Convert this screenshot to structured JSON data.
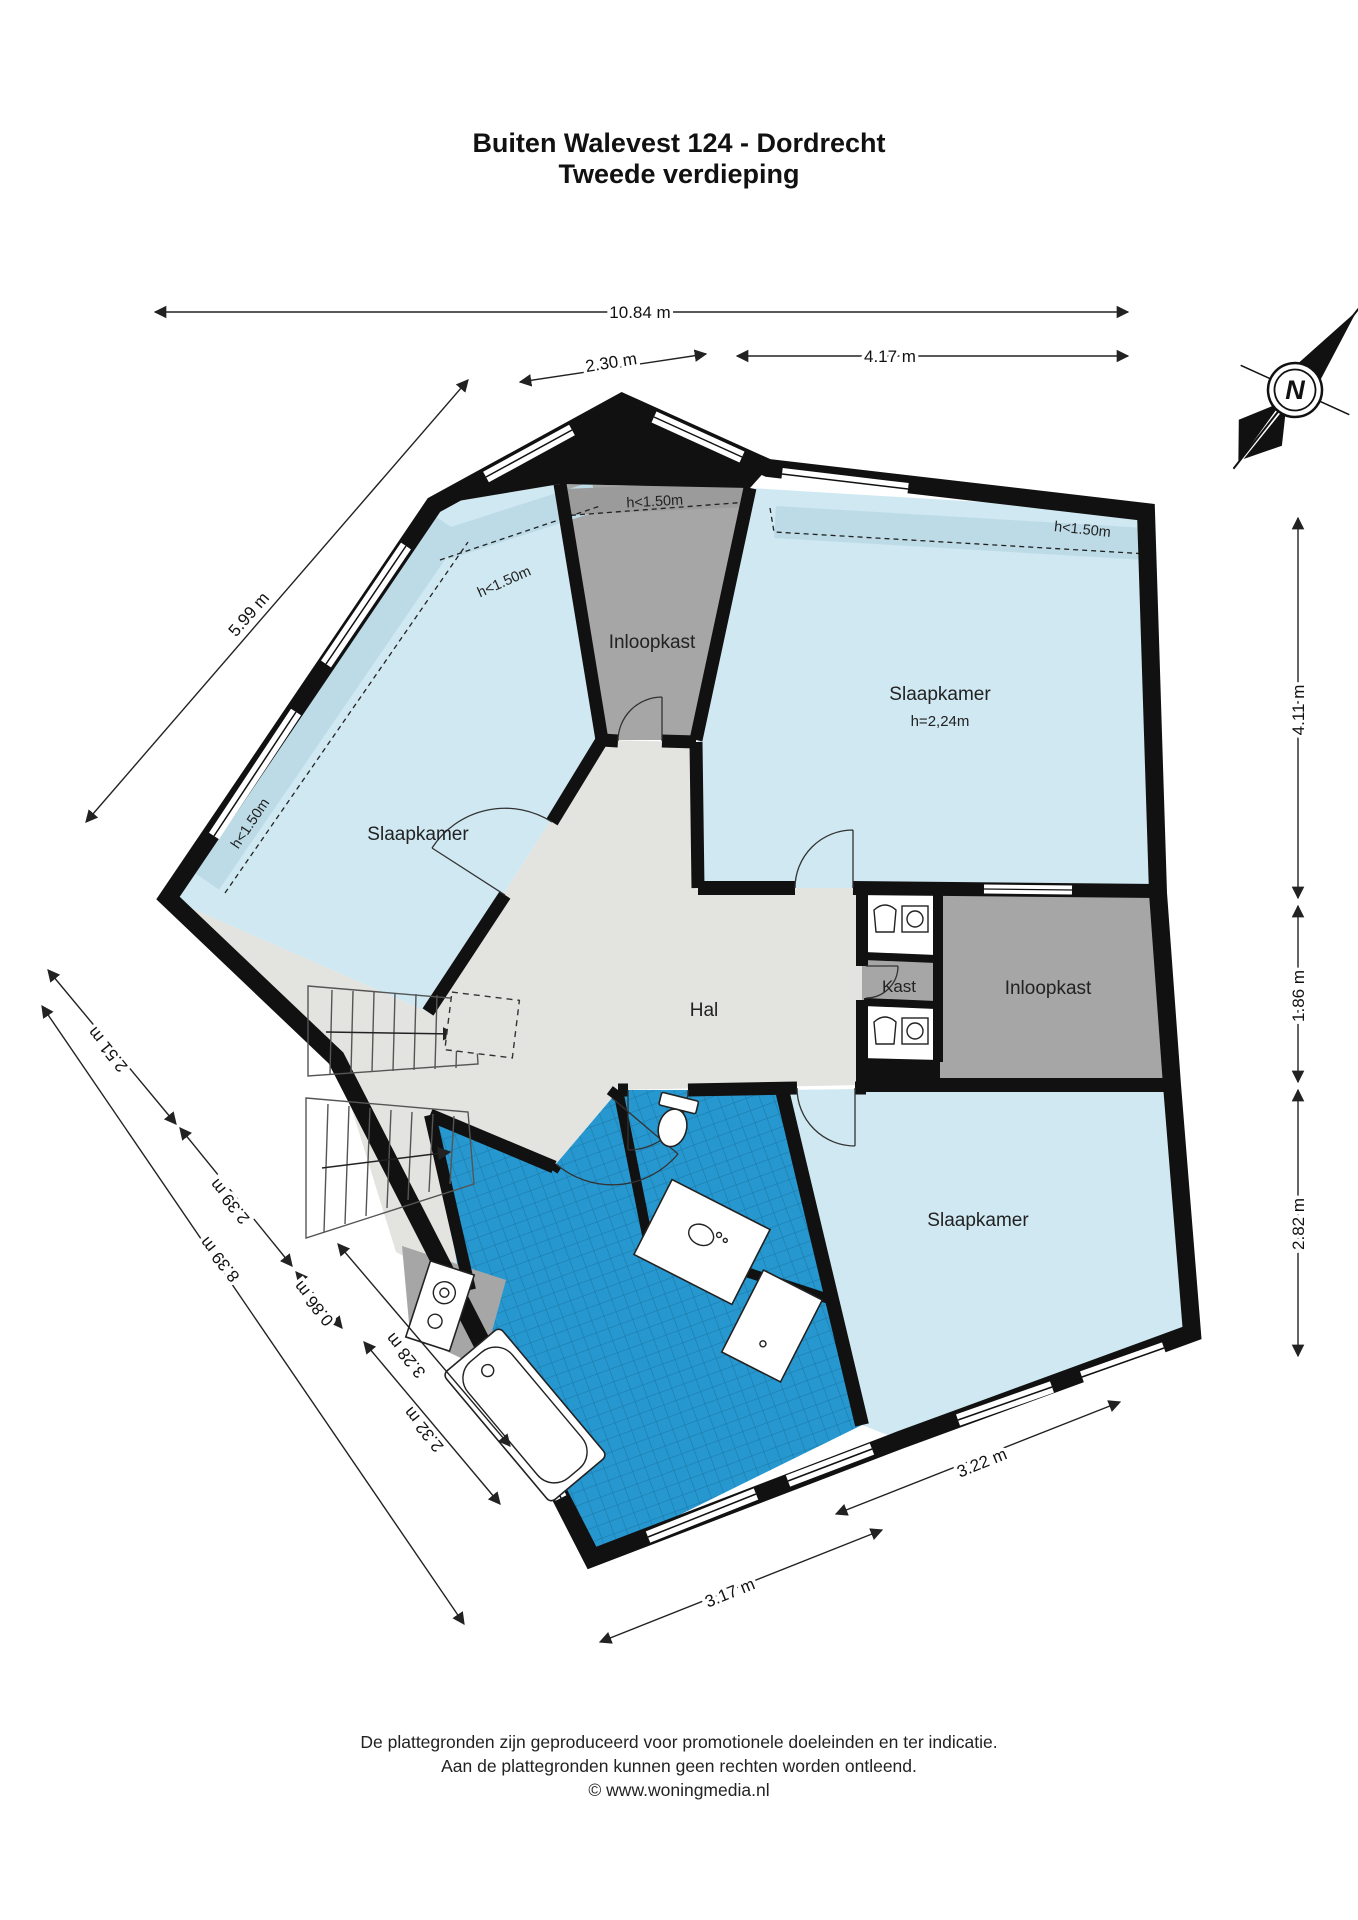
{
  "title": {
    "line1": "Buiten Walevest 124 - Dordrecht",
    "line2": "Tweede verdieping"
  },
  "rooms": {
    "bedroom_left": "Slaapkamer",
    "bedroom_top_right": "Slaapkamer",
    "bedroom_top_right_height": "h=2,24m",
    "bedroom_bottom_right": "Slaapkamer",
    "walkin_closet_top": "Inloopkast",
    "walkin_closet_right": "Inloopkast",
    "hall": "Hal",
    "closet": "Kast"
  },
  "height_notes": {
    "top_closet": "h<1.50m",
    "top_right_bedroom": "h<1.50m",
    "north_west_wall": "h<1.50m",
    "west_wall": "h<1.50m"
  },
  "dimensions": {
    "total_width": "10.84 m",
    "closet_top_width": "2.30 m",
    "bedroom_top_width": "4.17 m",
    "north_west_wall": "5.99 m",
    "right_top": "4.11 m",
    "right_middle": "1.86 m",
    "right_bottom": "2.82 m",
    "south_west_1": "2.51 m",
    "south_west_2": "2.39 m",
    "south_west_total": "8.39 m",
    "south_west_3": "0.86 m",
    "south_west_4": "3.28 m",
    "south_west_5": "2.32 m",
    "bottom_left": "3.17 m",
    "bottom_right": "3.22 m"
  },
  "compass": {
    "north": "N"
  },
  "footer": {
    "line1": "De plattegronden zijn geproduceerd voor promotionele doeleinden en ter indicatie.",
    "line2": "Aan de plattegronden kunnen geen rechten worden ontleend.",
    "line3": "© www.woningmedia.nl"
  },
  "colors": {
    "wall": "#111111",
    "room_blue": "#cfe8f2",
    "room_blue_low": "#bddbe7",
    "hall_grey": "#e3e3e0",
    "closet_grey": "#a6a6a6",
    "tile_blue": "#2798cf",
    "tile_grid": "#1a7cad"
  }
}
